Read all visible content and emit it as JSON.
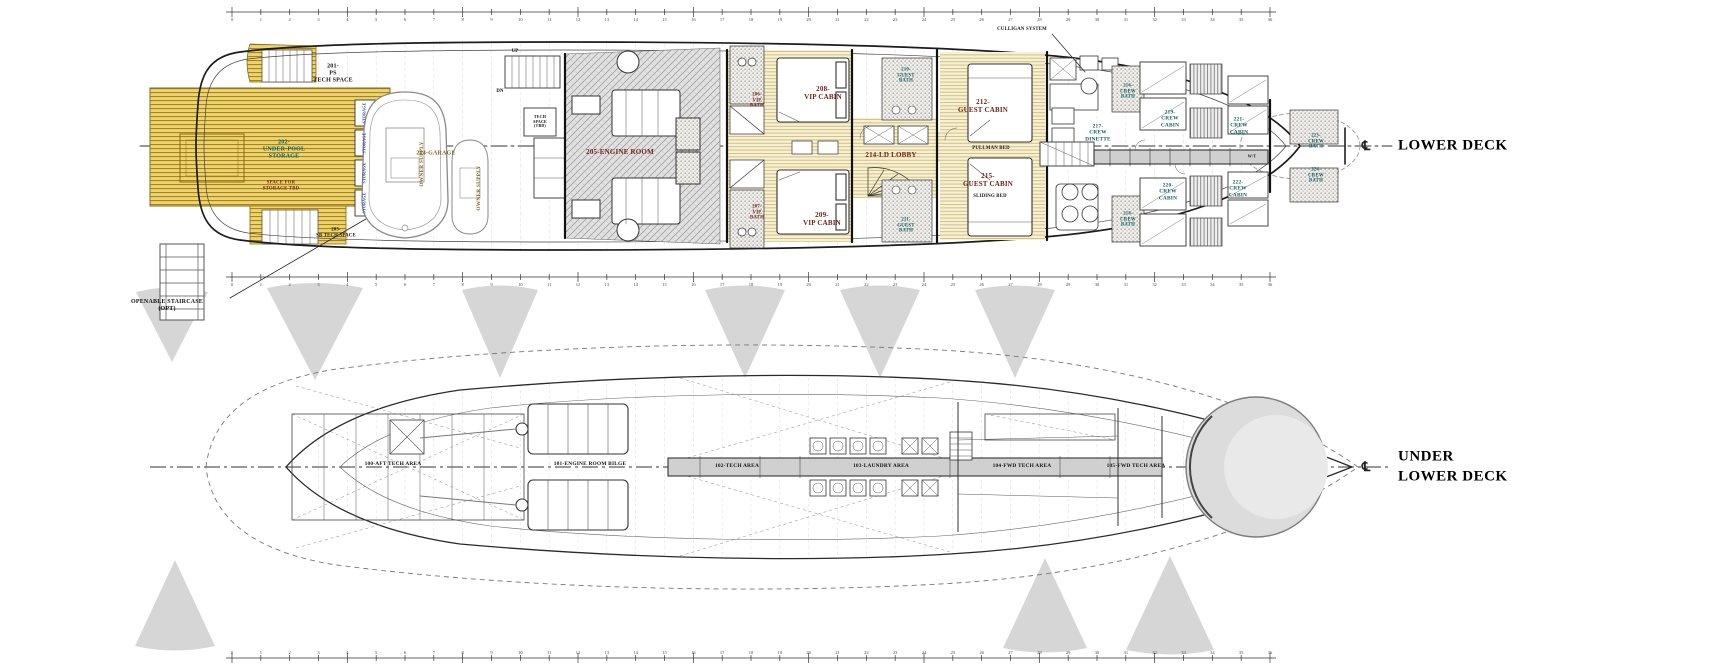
{
  "titles": {
    "deck1": "LOWER DECK",
    "deck2": "UNDER\nLOWER DECK",
    "centerline_symbol": "℄"
  },
  "lower_deck": {
    "rooms": {
      "ps_tech_space": "201-\nPS\nTECH SPACE",
      "under_pool_storage": "202-\nUNDER-POOL\nSTORAGE",
      "space_for_storage": "SPACE FOR\nSTORAGE TBD",
      "sb_tech_space": "203-\nSB TECH SPACE",
      "garage": "204-GARAGE",
      "owner_supply": "OWNER SUPPLY",
      "tech_space_tbd": "TECH\nSPACE\n(TBD)",
      "engine_room": "205-ENGINE ROOM",
      "vip_bath_206": "206-\nVIP\nBATH",
      "vip_bath_207": "207-\nVIP\nBATH",
      "vip_cabin_208": "208-\nVIP CABIN",
      "vip_cabin_209": "209-\nVIP CABIN",
      "guest_bath_210": "210-\nGUEST\nBATH",
      "guest_bath_211": "211-\nGUEST\nBATH",
      "guest_cabin_212": "212-\nGUEST CABIN",
      "ld_lobby_214": "214-LD LOBBY",
      "guest_cabin_215": "215-\nGUEST CABIN",
      "pullman_bed": "PULLMAN BED",
      "sliding_bed": "SLIDING BED",
      "crew_bath_216": "216-\nCREW\nBATH",
      "crew_dinette_217": "217-\nCREW\nDINETTE",
      "crew_bath_218": "218-\nCREW\nBATH",
      "crew_cabin_219": "219-\nCREW\nCABIN",
      "crew_cabin_220": "220-\nCREW\nCABIN",
      "crew_cabin_221": "221-\nCREW\nCABIN",
      "crew_cabin_222": "222-\nCREW\nCABIN",
      "crew_bath_223": "223-\nCREW\nBATH",
      "crew_bath_224": "224-\nCREW\nBATH",
      "storage_locker": "STORAGE",
      "wt_door": "W/T",
      "up": "UP",
      "dn": "DN"
    },
    "notes": {
      "openable_staircase": "OPENABLE STAIRCASE\n(OPT)",
      "culligan": "CULLIGAN SYSTEM"
    }
  },
  "under_lower_deck": {
    "areas": {
      "aft_tech_100": "100-AFT TECH AREA",
      "er_bilge_101": "101-ENGINE ROOM BILGE",
      "tech_102": "102-TECH AREA",
      "laundry_103": "103-LAUNDRY AREA",
      "fwd_tech_104": "104-FWD TECH AREA",
      "fwd_tech_105": "105-FWD TECH AREA"
    }
  },
  "rulers": {
    "frames": [
      0,
      1,
      2,
      3,
      4,
      5,
      6,
      7,
      8,
      9,
      10,
      11,
      12,
      13,
      14,
      15,
      16,
      17,
      18,
      19,
      20,
      21,
      22,
      23,
      24,
      25,
      26,
      27,
      28,
      29,
      30,
      31,
      32,
      33,
      34,
      35,
      36
    ]
  },
  "colors": {
    "wood_deck": "#d9b23a",
    "label_red": "#6e1f12",
    "label_teal": "#0e5e63",
    "label_gold": "#7d641c",
    "cone_grey": "#d6d6d6"
  }
}
